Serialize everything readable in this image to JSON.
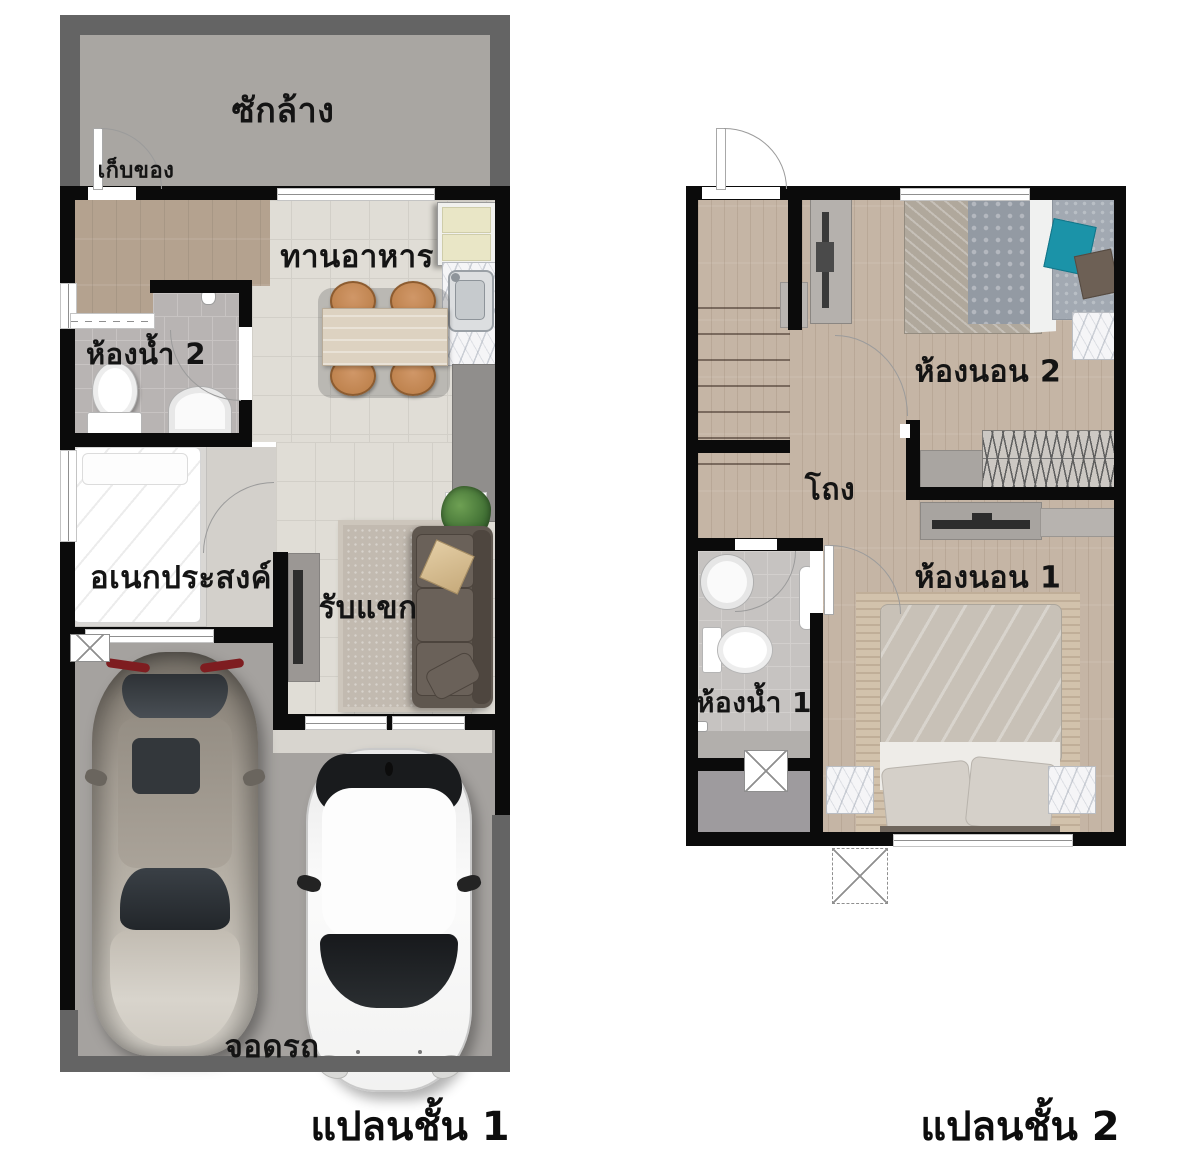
{
  "floor1": {
    "caption": "แปลนชั้น 1",
    "rooms": {
      "laundry": "ซักล้าง",
      "storage": "เก็บของ",
      "dining": "ทานอาหาร",
      "bathroom2": "ห้องน้ำ 2",
      "multipurpose": "อเนกประสงค์",
      "living": "รับแขก",
      "parking": "จอดรถ"
    }
  },
  "floor2": {
    "caption": "แปลนชั้น 2",
    "rooms": {
      "bedroom2": "ห้องนอน 2",
      "hall": "โถง",
      "bedroom1": "ห้องนอน 1",
      "bathroom1": "ห้องน้ำ 1"
    }
  },
  "colors": {
    "wall": "#0b0b0b",
    "outer_band": "#646464",
    "laundry_floor": "#a9a6a2",
    "tile_floor": "#e0ddd6",
    "bath_tile": "#b8b4b3",
    "wood_floor_f1": "#b4a28f",
    "wood_floor_f2": "#c5b5a5",
    "parking_floor": "#a5a29f",
    "sofa_brown": "#5f574f",
    "chair_orange": "#c4854f",
    "accent_teal": "#1b93a8"
  }
}
